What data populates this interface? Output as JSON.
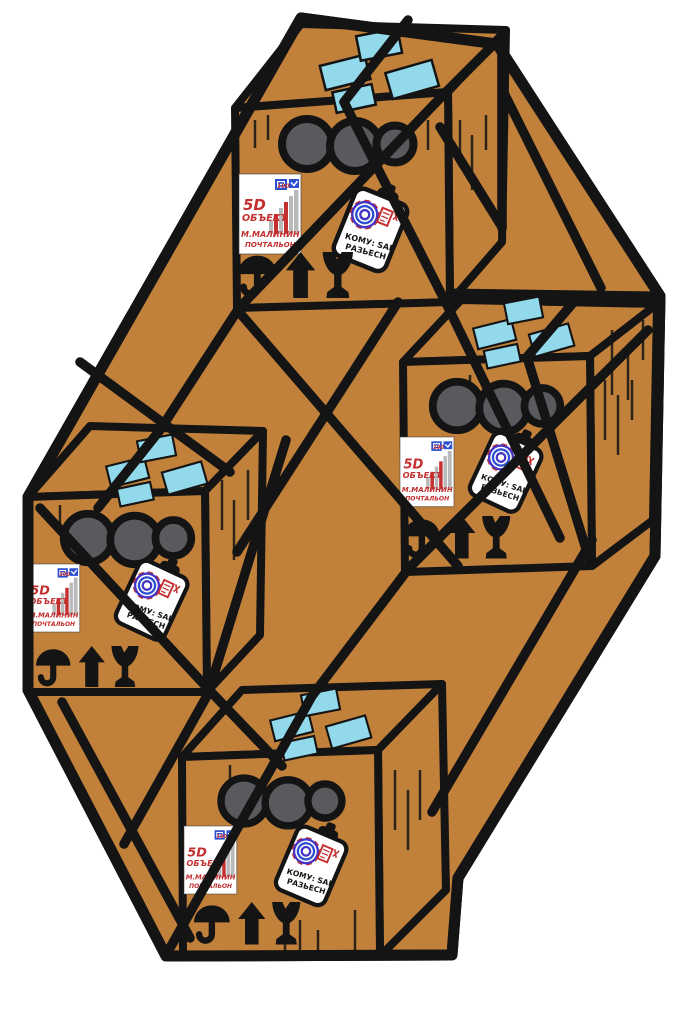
{
  "illustration": {
    "title": "Cartoon of four cardboard parcel boxes bundled with rope inside a large hexagonal cardboard shape",
    "box_count": 4,
    "boxes": [
      "top-parcel",
      "right-parcel",
      "left-parcel",
      "bottom-parcel"
    ]
  },
  "colors": {
    "background": "#ffffff",
    "cardboard": "#c2813b",
    "outline": "#141414",
    "tape_blue": "#92d9ec",
    "hole_gray": "#595a5e",
    "label_red": "#c42f2f",
    "postal_blue": "#2b4fd0",
    "stamp_purple": "#4333c6",
    "bar_gray": "#b9b9b9"
  },
  "shipping_label": {
    "line1": "5D",
    "line2": "ОБЪЕКТ",
    "line3": "М.МАЛИНИН",
    "line4": "ПОЧТАЛЬОН",
    "chart_top_value": "100"
  },
  "clipboard_note": {
    "line1": "КОМУ: SAI",
    "line2": "РАЗЬЕСН"
  },
  "care_symbols": [
    "keep-dry-umbrella-icon",
    "this-way-up-arrow-icon",
    "fragile-broken-glass-icon"
  ]
}
